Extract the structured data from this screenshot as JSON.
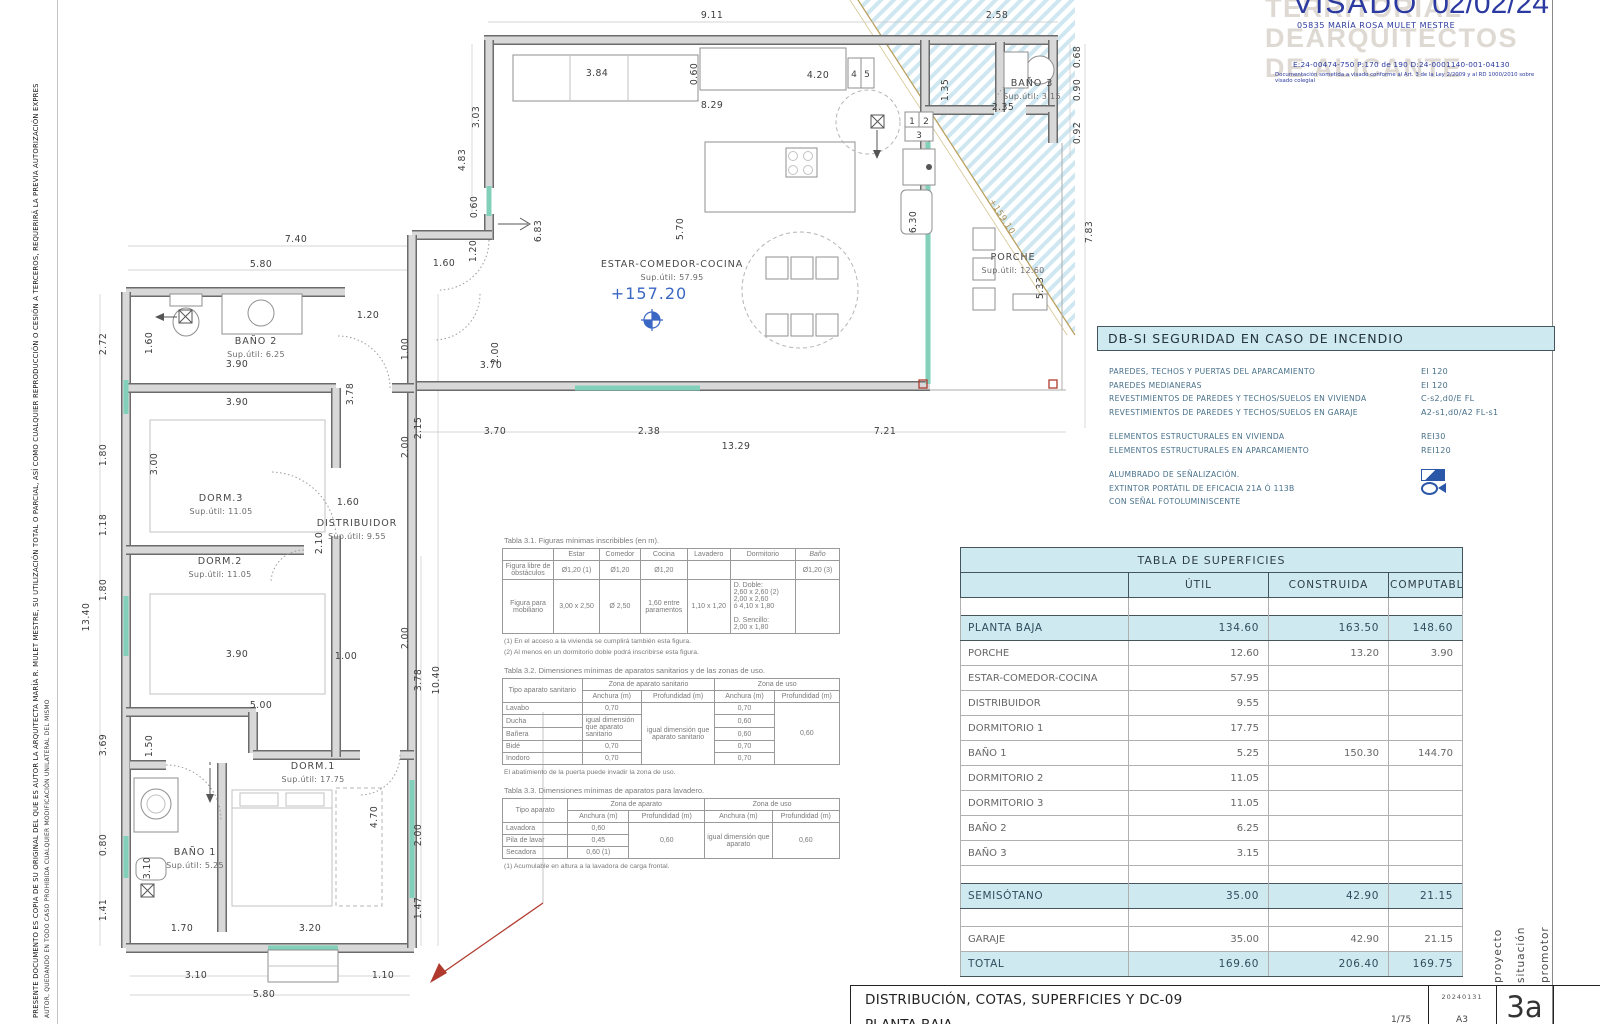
{
  "margin": {
    "copyright_line1": "PRESENTE DOCUMENTO ES COPIA DE SU ORIGINAL DEL QUE ES AUTOR LA ARQUITECTA MARÍA R. MULET MESTRE, SU UTILIZACIÓN TOTAL O PARCIAL, ASÍ COMO CUALQUIER REPRODUCCIÓN O CESIÓN A TERCEROS, REQUERIRÁ LA PREVIA AUTORIZACIÓN EXPRES",
    "copyright_line2": "AUTOR, QUEDANDO EN TODO CASO PROHIBIDA CUALQUIER MODIFICACIÓN UNILATERAL DEL MISMO"
  },
  "stamp": {
    "visado": "VISADO",
    "date": "02/02/24",
    "collegiate": "05835 MARÍA ROSA MULET MESTRE",
    "watermark1": "TERRITORIAL",
    "watermark2": "DEARQUITECTOS",
    "watermark3": "DE ALICANTE",
    "refs": "E:24-00474-750      P:170 de 190      D:24-0001140-001-04130",
    "legal": "Documentación sometida a visado conforme al Art. 3 de la Ley 2/2009 y al RD 1000/2010 sobre visado colegial"
  },
  "dbsi": {
    "title": "DB-SI   SEGURIDAD EN CASO DE INCENDIO",
    "groups": [
      [
        {
          "label": "PAREDES, TECHOS Y PUERTAS DEL APARCAMIENTO",
          "value": "EI 120"
        },
        {
          "label": "PAREDES MEDIANERAS",
          "value": "EI 120"
        },
        {
          "label": "REVESTIMIENTOS DE PAREDES Y TECHOS/SUELOS EN VIVIENDA",
          "value": "C-s2,d0/E FL"
        },
        {
          "label": "REVESTIMIENTOS DE PAREDES Y TECHOS/SUELOS EN GARAJE",
          "value": "A2-s1,d0/A2 FL-s1"
        }
      ],
      [
        {
          "label": "ELEMENTOS ESTRUCTURALES EN VIVIENDA",
          "value": "REI30"
        },
        {
          "label": "ELEMENTOS ESTRUCTURALES EN APARCAMIENTO",
          "value": "REI120"
        }
      ],
      [
        {
          "label": "ALUMBRADO DE SEÑALIZACIÓN.",
          "icon": "flag"
        },
        {
          "label": "EXTINTOR PORTÁTIL DE EFICACIA 21A Ó 113B",
          "icon": "ext"
        },
        {
          "label": "CON SEÑAL FOTOLUMINISCENTE"
        }
      ]
    ]
  },
  "superficies": {
    "title": "TABLA DE SUPERFICIES",
    "columns": [
      "ÚTIL",
      "CONSTRUIDA",
      "COMPUTABLE"
    ],
    "rows": [
      {
        "name": "PLANTA  BAJA",
        "util": "134.60",
        "construida": "163.50",
        "computable": "148.60",
        "type": "section"
      },
      {
        "name": "PORCHE",
        "util": "12.60",
        "construida": "13.20",
        "computable": "3.90"
      },
      {
        "name": "ESTAR-COMEDOR-COCINA",
        "util": "57.95"
      },
      {
        "name": "DISTRIBUIDOR",
        "util": "9.55"
      },
      {
        "name": "DORMITORIO 1",
        "util": "17.75"
      },
      {
        "name": "BAÑO 1",
        "util": "5.25",
        "construida": "150.30",
        "computable": "144.70"
      },
      {
        "name": "DORMITORIO 2",
        "util": "11.05"
      },
      {
        "name": "DORMITORIO 3",
        "util": "11.05"
      },
      {
        "name": "BAÑO 2",
        "util": "6.25"
      },
      {
        "name": "BAÑO 3",
        "util": "3.15"
      },
      {
        "type": "spacer"
      },
      {
        "name": "SEMISÓTANO",
        "util": "35.00",
        "construida": "42.90",
        "computable": "21.15",
        "type": "section"
      },
      {
        "type": "spacer"
      },
      {
        "name": "GARAJE",
        "util": "35.00",
        "construida": "42.90",
        "computable": "21.15"
      },
      {
        "name": "TOTAL",
        "util": "169.60",
        "construida": "206.40",
        "computable": "169.75",
        "type": "section"
      }
    ]
  },
  "tables": {
    "t31": {
      "title": "Tabla 3.1. Figuras mínimas inscribibles (en m).",
      "header": [
        "",
        "Estar",
        "Comedor",
        "Cocina",
        "Lavadero",
        "Dormitorio",
        "Baño"
      ],
      "r1": [
        "Figura libre de obstáculos",
        "Ø1,20 (1)",
        "Ø1,20",
        "Ø1,20",
        "",
        "",
        "Ø1,20 (3)"
      ],
      "r2": [
        "Figura para mobiliario",
        "3,00 x 2,50",
        "Ø 2,50",
        "1,60 entre paramentos",
        "1,10 x 1,20",
        "D. Doble:\n2,60 x 2,60 (2)\n2,00 x 2,60\nó 4,10 x 1,80\n\nD. Sencillo:\n2,00 x 1,80",
        ""
      ],
      "note1": "(1) En el acceso a la vivienda se cumplirá también esta figura.",
      "note2": "(2) Al menos en un dormitorio doble podrá inscribirse esta figura."
    },
    "t32": {
      "title": "Tabla 3.2. Dimensiones mínimas de aparatos sanitarios y de las zonas de uso.",
      "col_tipo": "Tipo aparato sanitario",
      "grp1": "Zona de aparato sanitario",
      "grp2": "Zona de uso",
      "anch": "Anchura (m)",
      "prof": "Profundidad (m)",
      "lavabo": "Lavabo",
      "v_lavabo_a": "0,70",
      "span_prof": "igual dimensión que aparato sanitario",
      "v_lavabo_ua": "0,70",
      "span_uso": "0,60",
      "ducha": "Ducha",
      "span_igual": "igual dimensión que aparato sanitario",
      "v_ducha_ua": "0,60",
      "banera": "Bañera",
      "v_banera_ua": "0,60",
      "bide": "Bidé",
      "v_bide_a": "0,70",
      "v_bide_ua": "0,70",
      "inodoro": "Inodoro",
      "v_inodoro_a": "0,70",
      "v_inodoro_ua": "0,70",
      "note": "El abatimiento de la puerta puede invadir la zona de uso."
    },
    "t33": {
      "title": "Tabla 3.3. Dimensiones mínimas de aparatos para lavadero.",
      "col_tipo": "Tipo aparato",
      "grp1": "Zona de aparato",
      "grp2": "Zona de uso",
      "anch": "Anchura (m)",
      "prof": "Profundidad (m)",
      "lavadora": "Lavadora",
      "v_lavadora": "0,60",
      "span_prof": "0,60",
      "span_uso_a": "igual dimensión que aparato",
      "span_uso_p": "0,60",
      "pila": "Pila de lavar",
      "v_pila": "0,45",
      "secadora": "Secadora",
      "v_secadora": "0,60 (1)",
      "note": "(1) Acumulable en altura a la lavadora de carga frontal."
    }
  },
  "titleblock": {
    "line1": "DISTRIBUCIÓN, COTAS, SUPERFICIES Y DC-09",
    "line2": "PLANTA BAJA",
    "code": "20240131",
    "scale": "1/75",
    "size": "A3",
    "sheet": "3a",
    "side_labels": [
      "proyecto",
      "situación",
      "promotor"
    ]
  },
  "floorplan": {
    "level_main": "+157.20",
    "level_ramp": "+159.10",
    "appliances": [
      "1",
      "2",
      "3",
      "4",
      "5"
    ],
    "rooms": [
      {
        "name": "ESTAR-COMEDOR-COCINA",
        "sup": "Sup.útil: 57.95",
        "x": 672,
        "y": 267
      },
      {
        "name": "PORCHE",
        "sup": "Sup.útil: 12.60",
        "x": 1013,
        "y": 260
      },
      {
        "name": "BAÑO 3",
        "sup": "Sup.útil: 3.15",
        "x": 1032,
        "y": 86
      },
      {
        "name": "BAÑO 2",
        "sup": "Sup.útil: 6.25",
        "x": 256,
        "y": 344
      },
      {
        "name": "DORM.3",
        "sup": "Sup.útil: 11.05",
        "x": 221,
        "y": 501
      },
      {
        "name": "DISTRIBUIDOR",
        "sup": "Sup.útil: 9.55",
        "x": 357,
        "y": 526
      },
      {
        "name": "DORM.2",
        "sup": "Sup.útil: 11.05",
        "x": 220,
        "y": 564
      },
      {
        "name": "DORM.1",
        "sup": "Sup.útil: 17.75",
        "x": 313,
        "y": 769
      },
      {
        "name": "BAÑO 1",
        "sup": "Sup.útil: 5.25",
        "x": 195,
        "y": 855
      }
    ],
    "dims": [
      {
        "t": "9.11",
        "x": 712,
        "y": 18
      },
      {
        "t": "2.58",
        "x": 997,
        "y": 18
      },
      {
        "t": "0.68",
        "x": 1080,
        "y": 57,
        "r": -90
      },
      {
        "t": "0.90",
        "x": 1080,
        "y": 90,
        "r": -90
      },
      {
        "t": "0.92",
        "x": 1080,
        "y": 133,
        "r": -90
      },
      {
        "t": "7.83",
        "x": 1092,
        "y": 232,
        "r": -90
      },
      {
        "t": "5.33",
        "x": 1043,
        "y": 288,
        "r": -90
      },
      {
        "t": "3.84",
        "x": 597,
        "y": 76
      },
      {
        "t": "0.60",
        "x": 697,
        "y": 74,
        "r": -90
      },
      {
        "t": "8.29",
        "x": 712,
        "y": 108
      },
      {
        "t": "4.20",
        "x": 818,
        "y": 78
      },
      {
        "t": "1.35",
        "x": 948,
        "y": 90,
        "r": -90
      },
      {
        "t": "2.35",
        "x": 1003,
        "y": 110
      },
      {
        "t": "3.03",
        "x": 479,
        "y": 117,
        "r": -90
      },
      {
        "t": "4.83",
        "x": 465,
        "y": 160,
        "r": -90
      },
      {
        "t": "0.60",
        "x": 477,
        "y": 207,
        "r": -90
      },
      {
        "t": "6.83",
        "x": 541,
        "y": 231,
        "r": -90
      },
      {
        "t": "5.70",
        "x": 683,
        "y": 229,
        "r": -90
      },
      {
        "t": "6.30",
        "x": 916,
        "y": 222,
        "r": -90
      },
      {
        "t": "1.20",
        "x": 476,
        "y": 251,
        "r": -90
      },
      {
        "t": "1.60",
        "x": 444,
        "y": 266
      },
      {
        "t": "7.40",
        "x": 296,
        "y": 242
      },
      {
        "t": "5.80",
        "x": 261,
        "y": 267
      },
      {
        "t": "1.20",
        "x": 368,
        "y": 318
      },
      {
        "t": "2.72",
        "x": 106,
        "y": 344,
        "r": -90
      },
      {
        "t": "1.60",
        "x": 152,
        "y": 343,
        "r": -90
      },
      {
        "t": "3.90",
        "x": 237,
        "y": 367
      },
      {
        "t": "1.00",
        "x": 408,
        "y": 349,
        "r": -90
      },
      {
        "t": "2.00",
        "x": 498,
        "y": 353,
        "r": -90
      },
      {
        "t": "3.70",
        "x": 491,
        "y": 368
      },
      {
        "t": "3.90",
        "x": 237,
        "y": 405
      },
      {
        "t": "3.78",
        "x": 353,
        "y": 394,
        "r": -90
      },
      {
        "t": "2.15",
        "x": 421,
        "y": 428,
        "r": -90
      },
      {
        "t": "3.70",
        "x": 495,
        "y": 434
      },
      {
        "t": "2.38",
        "x": 649,
        "y": 434
      },
      {
        "t": "7.21",
        "x": 885,
        "y": 434
      },
      {
        "t": "13.29",
        "x": 736,
        "y": 449
      },
      {
        "t": "1.80",
        "x": 106,
        "y": 455,
        "r": -90
      },
      {
        "t": "3.00",
        "x": 157,
        "y": 464,
        "r": -90
      },
      {
        "t": "1.18",
        "x": 106,
        "y": 525,
        "r": -90
      },
      {
        "t": "1.60",
        "x": 348,
        "y": 505
      },
      {
        "t": "2.10",
        "x": 322,
        "y": 543,
        "r": -90
      },
      {
        "t": "1.80",
        "x": 106,
        "y": 590,
        "r": -90
      },
      {
        "t": "13.40",
        "x": 89,
        "y": 617,
        "r": -90
      },
      {
        "t": "2.00",
        "x": 408,
        "y": 447,
        "r": -90
      },
      {
        "t": "2.00",
        "x": 408,
        "y": 638,
        "r": -90
      },
      {
        "t": "3.90",
        "x": 237,
        "y": 657
      },
      {
        "t": "1.00",
        "x": 346,
        "y": 659
      },
      {
        "t": "3.78",
        "x": 421,
        "y": 680,
        "r": -90
      },
      {
        "t": "10.40",
        "x": 439,
        "y": 680,
        "r": -90
      },
      {
        "t": "5.00",
        "x": 261,
        "y": 708
      },
      {
        "t": "3.69",
        "x": 106,
        "y": 745,
        "r": -90
      },
      {
        "t": "1.50",
        "x": 152,
        "y": 746,
        "r": -90
      },
      {
        "t": "4.70",
        "x": 377,
        "y": 817,
        "r": -90
      },
      {
        "t": "2.00",
        "x": 421,
        "y": 835,
        "r": -90
      },
      {
        "t": "0.80",
        "x": 106,
        "y": 845,
        "r": -90
      },
      {
        "t": "3.10",
        "x": 150,
        "y": 868,
        "r": -90
      },
      {
        "t": "1.41",
        "x": 106,
        "y": 910,
        "r": -90
      },
      {
        "t": "1.70",
        "x": 182,
        "y": 931
      },
      {
        "t": "3.20",
        "x": 310,
        "y": 931
      },
      {
        "t": "1.47",
        "x": 421,
        "y": 908,
        "r": -90
      },
      {
        "t": "3.10",
        "x": 196,
        "y": 978
      },
      {
        "t": "1.10",
        "x": 383,
        "y": 978
      },
      {
        "t": "5.80",
        "x": 264,
        "y": 997
      }
    ]
  }
}
